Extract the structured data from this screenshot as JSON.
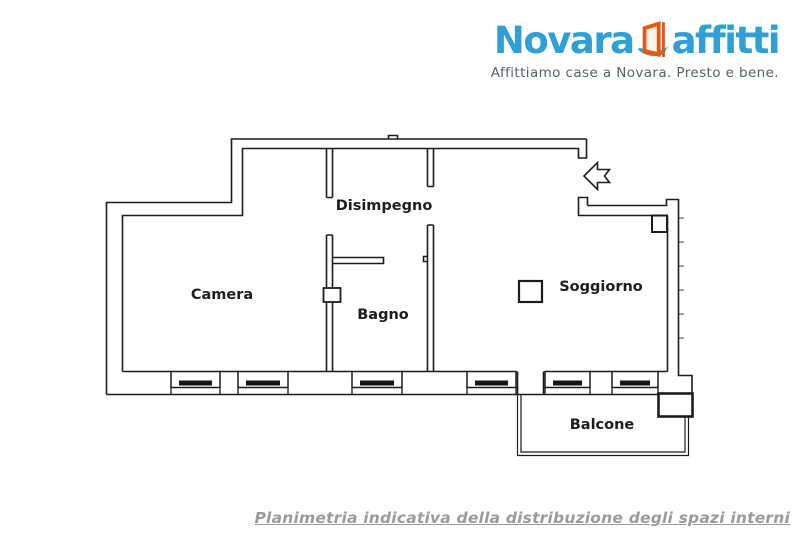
{
  "header": {
    "logo": {
      "word1": "Novara",
      "word2": "affitti",
      "tagline": "Affittiamo case a Novara. Presto e bene."
    },
    "colors": {
      "brand_blue": "#2F9FD5",
      "brand_orange": "#E8570E",
      "tagline_gray": "#55626B"
    }
  },
  "floorplan": {
    "wall_color": "#1C1C1C",
    "rooms": [
      {
        "id": "camera",
        "label": "Camera"
      },
      {
        "id": "disimpegno",
        "label": "Disimpegno"
      },
      {
        "id": "bagno",
        "label": "Bagno"
      },
      {
        "id": "soggiorno",
        "label": "Soggiorno"
      },
      {
        "id": "balcone",
        "label": "Balcone"
      }
    ],
    "entrance_arrow_direction": "left",
    "window_count": 6
  },
  "footer": {
    "caption": "Planimetria indicativa della distribuzione degli spazi interni",
    "caption_color": "#9B9B9B"
  }
}
